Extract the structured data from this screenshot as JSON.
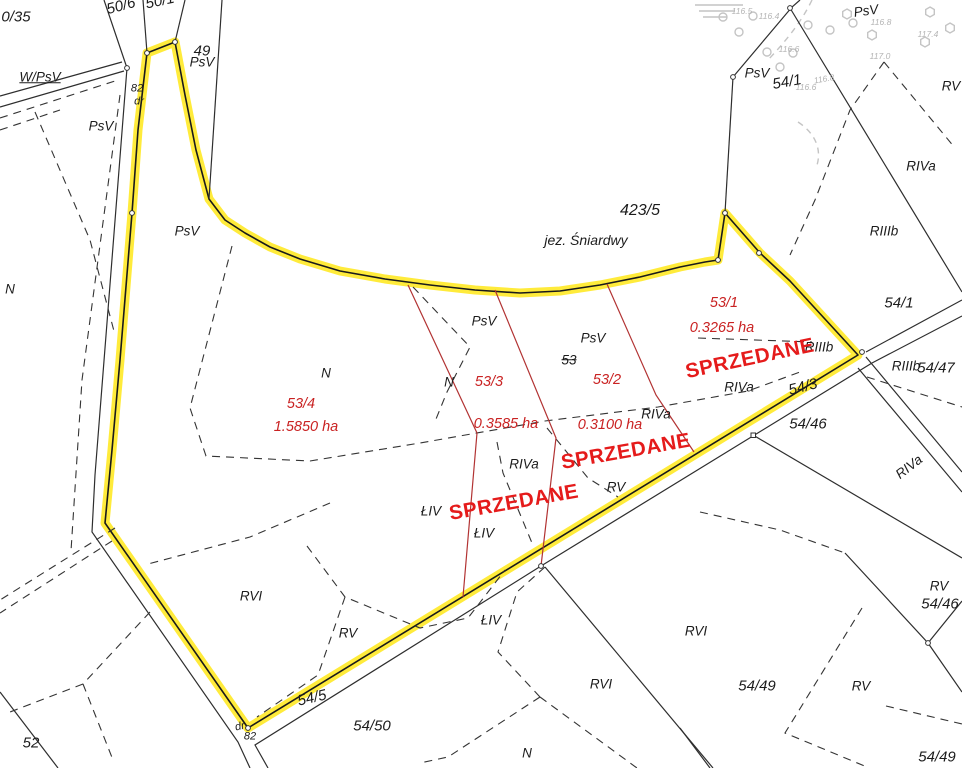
{
  "map": {
    "type": "cadastral-survey-map",
    "water_body": "jez. Śniardwy",
    "colors": {
      "background": "#ffffff",
      "boundary_highlight": "#ffe92a",
      "parcel_line": "#2e2e2e",
      "subdivision_line": "#b23333",
      "red_text": "#c92222",
      "sold_stamp": "#e51b1b",
      "gray_symbols": "#c4c4c4"
    },
    "labels": [
      {
        "t": "0/35",
        "x": 16,
        "y": 17,
        "c": "num"
      },
      {
        "t": "50/6",
        "x": 121,
        "y": 6,
        "c": "num",
        "r": -15
      },
      {
        "t": "50/1",
        "x": 160,
        "y": 1,
        "c": "num",
        "r": -12
      },
      {
        "t": "W/PsV",
        "x": 40,
        "y": 77,
        "c": "underline"
      },
      {
        "t": "82",
        "x": 137,
        "y": 89,
        "c": "small"
      },
      {
        "t": "dr",
        "x": 139,
        "y": 102,
        "c": "small"
      },
      {
        "t": "49",
        "x": 202,
        "y": 51,
        "c": "num"
      },
      {
        "t": "PsV",
        "x": 202,
        "y": 62,
        "c": ""
      },
      {
        "t": "PsV",
        "x": 101,
        "y": 126,
        "c": ""
      },
      {
        "t": "PsV",
        "x": 187,
        "y": 231,
        "c": ""
      },
      {
        "t": "N",
        "x": 10,
        "y": 289,
        "c": ""
      },
      {
        "t": "423/5",
        "x": 640,
        "y": 211,
        "c": "big"
      },
      {
        "t": "jez. Śniardwy",
        "x": 586,
        "y": 240,
        "c": "lake"
      },
      {
        "t": "PsV",
        "x": 866,
        "y": 11,
        "c": "",
        "r": -8
      },
      {
        "t": "116.5",
        "x": 742,
        "y": 11,
        "c": "gray"
      },
      {
        "t": "116.4",
        "x": 769,
        "y": 16,
        "c": "gray"
      },
      {
        "t": "116.8",
        "x": 881,
        "y": 22,
        "c": "gray"
      },
      {
        "t": "117.4",
        "x": 928,
        "y": 34,
        "c": "gray"
      },
      {
        "t": "116.6",
        "x": 789,
        "y": 49,
        "c": "gray"
      },
      {
        "t": "117.0",
        "x": 880,
        "y": 56,
        "c": "gray"
      },
      {
        "t": "116.8",
        "x": 824,
        "y": 79,
        "c": "gray",
        "r": -10
      },
      {
        "t": "116.6",
        "x": 806,
        "y": 87,
        "c": "gray"
      },
      {
        "t": "PsV",
        "x": 757,
        "y": 73,
        "c": ""
      },
      {
        "t": "54/1",
        "x": 787,
        "y": 82,
        "c": "num",
        "r": -10
      },
      {
        "t": "RV",
        "x": 951,
        "y": 86,
        "c": ""
      },
      {
        "t": "RIVa",
        "x": 921,
        "y": 166,
        "c": ""
      },
      {
        "t": "RIIIb",
        "x": 884,
        "y": 231,
        "c": ""
      },
      {
        "t": "54/1",
        "x": 899,
        "y": 303,
        "c": "num"
      },
      {
        "t": "PsV",
        "x": 484,
        "y": 321,
        "c": ""
      },
      {
        "t": "PsV",
        "x": 593,
        "y": 338,
        "c": ""
      },
      {
        "t": "53",
        "x": 569,
        "y": 360,
        "c": "strike"
      },
      {
        "t": "N",
        "x": 326,
        "y": 373,
        "c": ""
      },
      {
        "t": "N",
        "x": 449,
        "y": 382,
        "c": ""
      },
      {
        "t": "RIIIb",
        "x": 819,
        "y": 347,
        "c": ""
      },
      {
        "t": "RIIIb",
        "x": 906,
        "y": 366,
        "c": ""
      },
      {
        "t": "54/47",
        "x": 936,
        "y": 368,
        "c": "num"
      },
      {
        "t": "54/3",
        "x": 803,
        "y": 387,
        "c": "num",
        "r": -14
      },
      {
        "t": "RIVa",
        "x": 739,
        "y": 387,
        "c": ""
      },
      {
        "t": "RIVa",
        "x": 656,
        "y": 414,
        "c": ""
      },
      {
        "t": "54/46",
        "x": 808,
        "y": 424,
        "c": "num"
      },
      {
        "t": "RIVa",
        "x": 909,
        "y": 467,
        "c": "",
        "r": -38
      },
      {
        "t": "RIVa",
        "x": 524,
        "y": 464,
        "c": ""
      },
      {
        "t": "RV",
        "x": 616,
        "y": 487,
        "c": ""
      },
      {
        "t": "ŁIV",
        "x": 431,
        "y": 511,
        "c": ""
      },
      {
        "t": "ŁIV",
        "x": 484,
        "y": 533,
        "c": ""
      },
      {
        "t": "RVI",
        "x": 251,
        "y": 596,
        "c": ""
      },
      {
        "t": "RV",
        "x": 348,
        "y": 633,
        "c": ""
      },
      {
        "t": "ŁIV",
        "x": 491,
        "y": 620,
        "c": ""
      },
      {
        "t": "RVI",
        "x": 696,
        "y": 631,
        "c": ""
      },
      {
        "t": "RVI",
        "x": 601,
        "y": 684,
        "c": ""
      },
      {
        "t": "RV",
        "x": 939,
        "y": 586,
        "c": ""
      },
      {
        "t": "54/46",
        "x": 940,
        "y": 604,
        "c": "num"
      },
      {
        "t": "54/49",
        "x": 757,
        "y": 686,
        "c": "num"
      },
      {
        "t": "RV",
        "x": 861,
        "y": 686,
        "c": ""
      },
      {
        "t": "54/5",
        "x": 312,
        "y": 698,
        "c": "num",
        "r": -13
      },
      {
        "t": "54/50",
        "x": 372,
        "y": 726,
        "c": "num"
      },
      {
        "t": "dr",
        "x": 240,
        "y": 727,
        "c": "small",
        "r": -12
      },
      {
        "t": "82",
        "x": 250,
        "y": 737,
        "c": "small"
      },
      {
        "t": "52",
        "x": 31,
        "y": 743,
        "c": "num"
      },
      {
        "t": "N",
        "x": 527,
        "y": 753,
        "c": ""
      },
      {
        "t": "54/49",
        "x": 937,
        "y": 757,
        "c": "num"
      },
      {
        "t": "53/1",
        "x": 724,
        "y": 303,
        "c": "red"
      },
      {
        "t": "0.3265 ha",
        "x": 722,
        "y": 328,
        "c": "red"
      },
      {
        "t": "53/3",
        "x": 489,
        "y": 382,
        "c": "red"
      },
      {
        "t": "0.3585 ha",
        "x": 506,
        "y": 424,
        "c": "red"
      },
      {
        "t": "53/2",
        "x": 607,
        "y": 380,
        "c": "red"
      },
      {
        "t": "0.3100 ha",
        "x": 610,
        "y": 425,
        "c": "red"
      },
      {
        "t": "53/4",
        "x": 301,
        "y": 404,
        "c": "red"
      },
      {
        "t": "1.5850 ha",
        "x": 306,
        "y": 427,
        "c": "red"
      },
      {
        "t": "SPRZEDANE",
        "x": 750,
        "y": 359,
        "c": "sold",
        "r": -12
      },
      {
        "t": "SPRZEDANE",
        "x": 626,
        "y": 452,
        "c": "sold",
        "r": -10
      },
      {
        "t": "SPRZEDANE",
        "x": 514,
        "y": 503,
        "c": "sold",
        "r": -10
      }
    ]
  }
}
